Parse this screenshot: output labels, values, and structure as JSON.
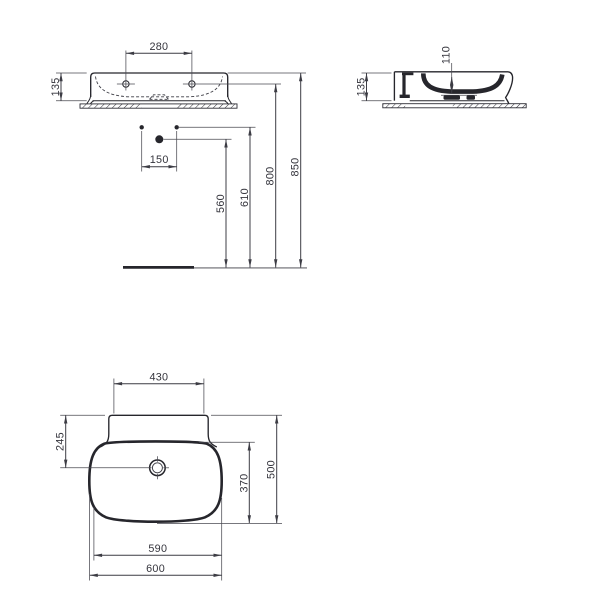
{
  "drawing": {
    "type": "washbasin-technical-dimension-drawing",
    "background": "#ffffff",
    "line_color": "#3c3c44",
    "thick_line_color": "#26262c",
    "text_color": "#35353d",
    "views": {
      "front_elevation": {
        "name": "front elevation with wall connections",
        "dims": {
          "taphole_spacing": "280",
          "basin_height": "135",
          "supply_spacing": "150",
          "waste_height": "560",
          "supply_height": "610",
          "taphole_height": "800",
          "rim_height": "850"
        }
      },
      "side_elevation": {
        "name": "side section",
        "dims": {
          "basin_height": "135",
          "bowl_depth": "110"
        }
      },
      "plan": {
        "name": "plan view",
        "dims": {
          "back_ledge_width": "430",
          "waste_from_back": "245",
          "bowl_front_depth": "370",
          "overall_depth": "500",
          "bowl_width": "590",
          "overall_width": "600"
        }
      }
    }
  }
}
